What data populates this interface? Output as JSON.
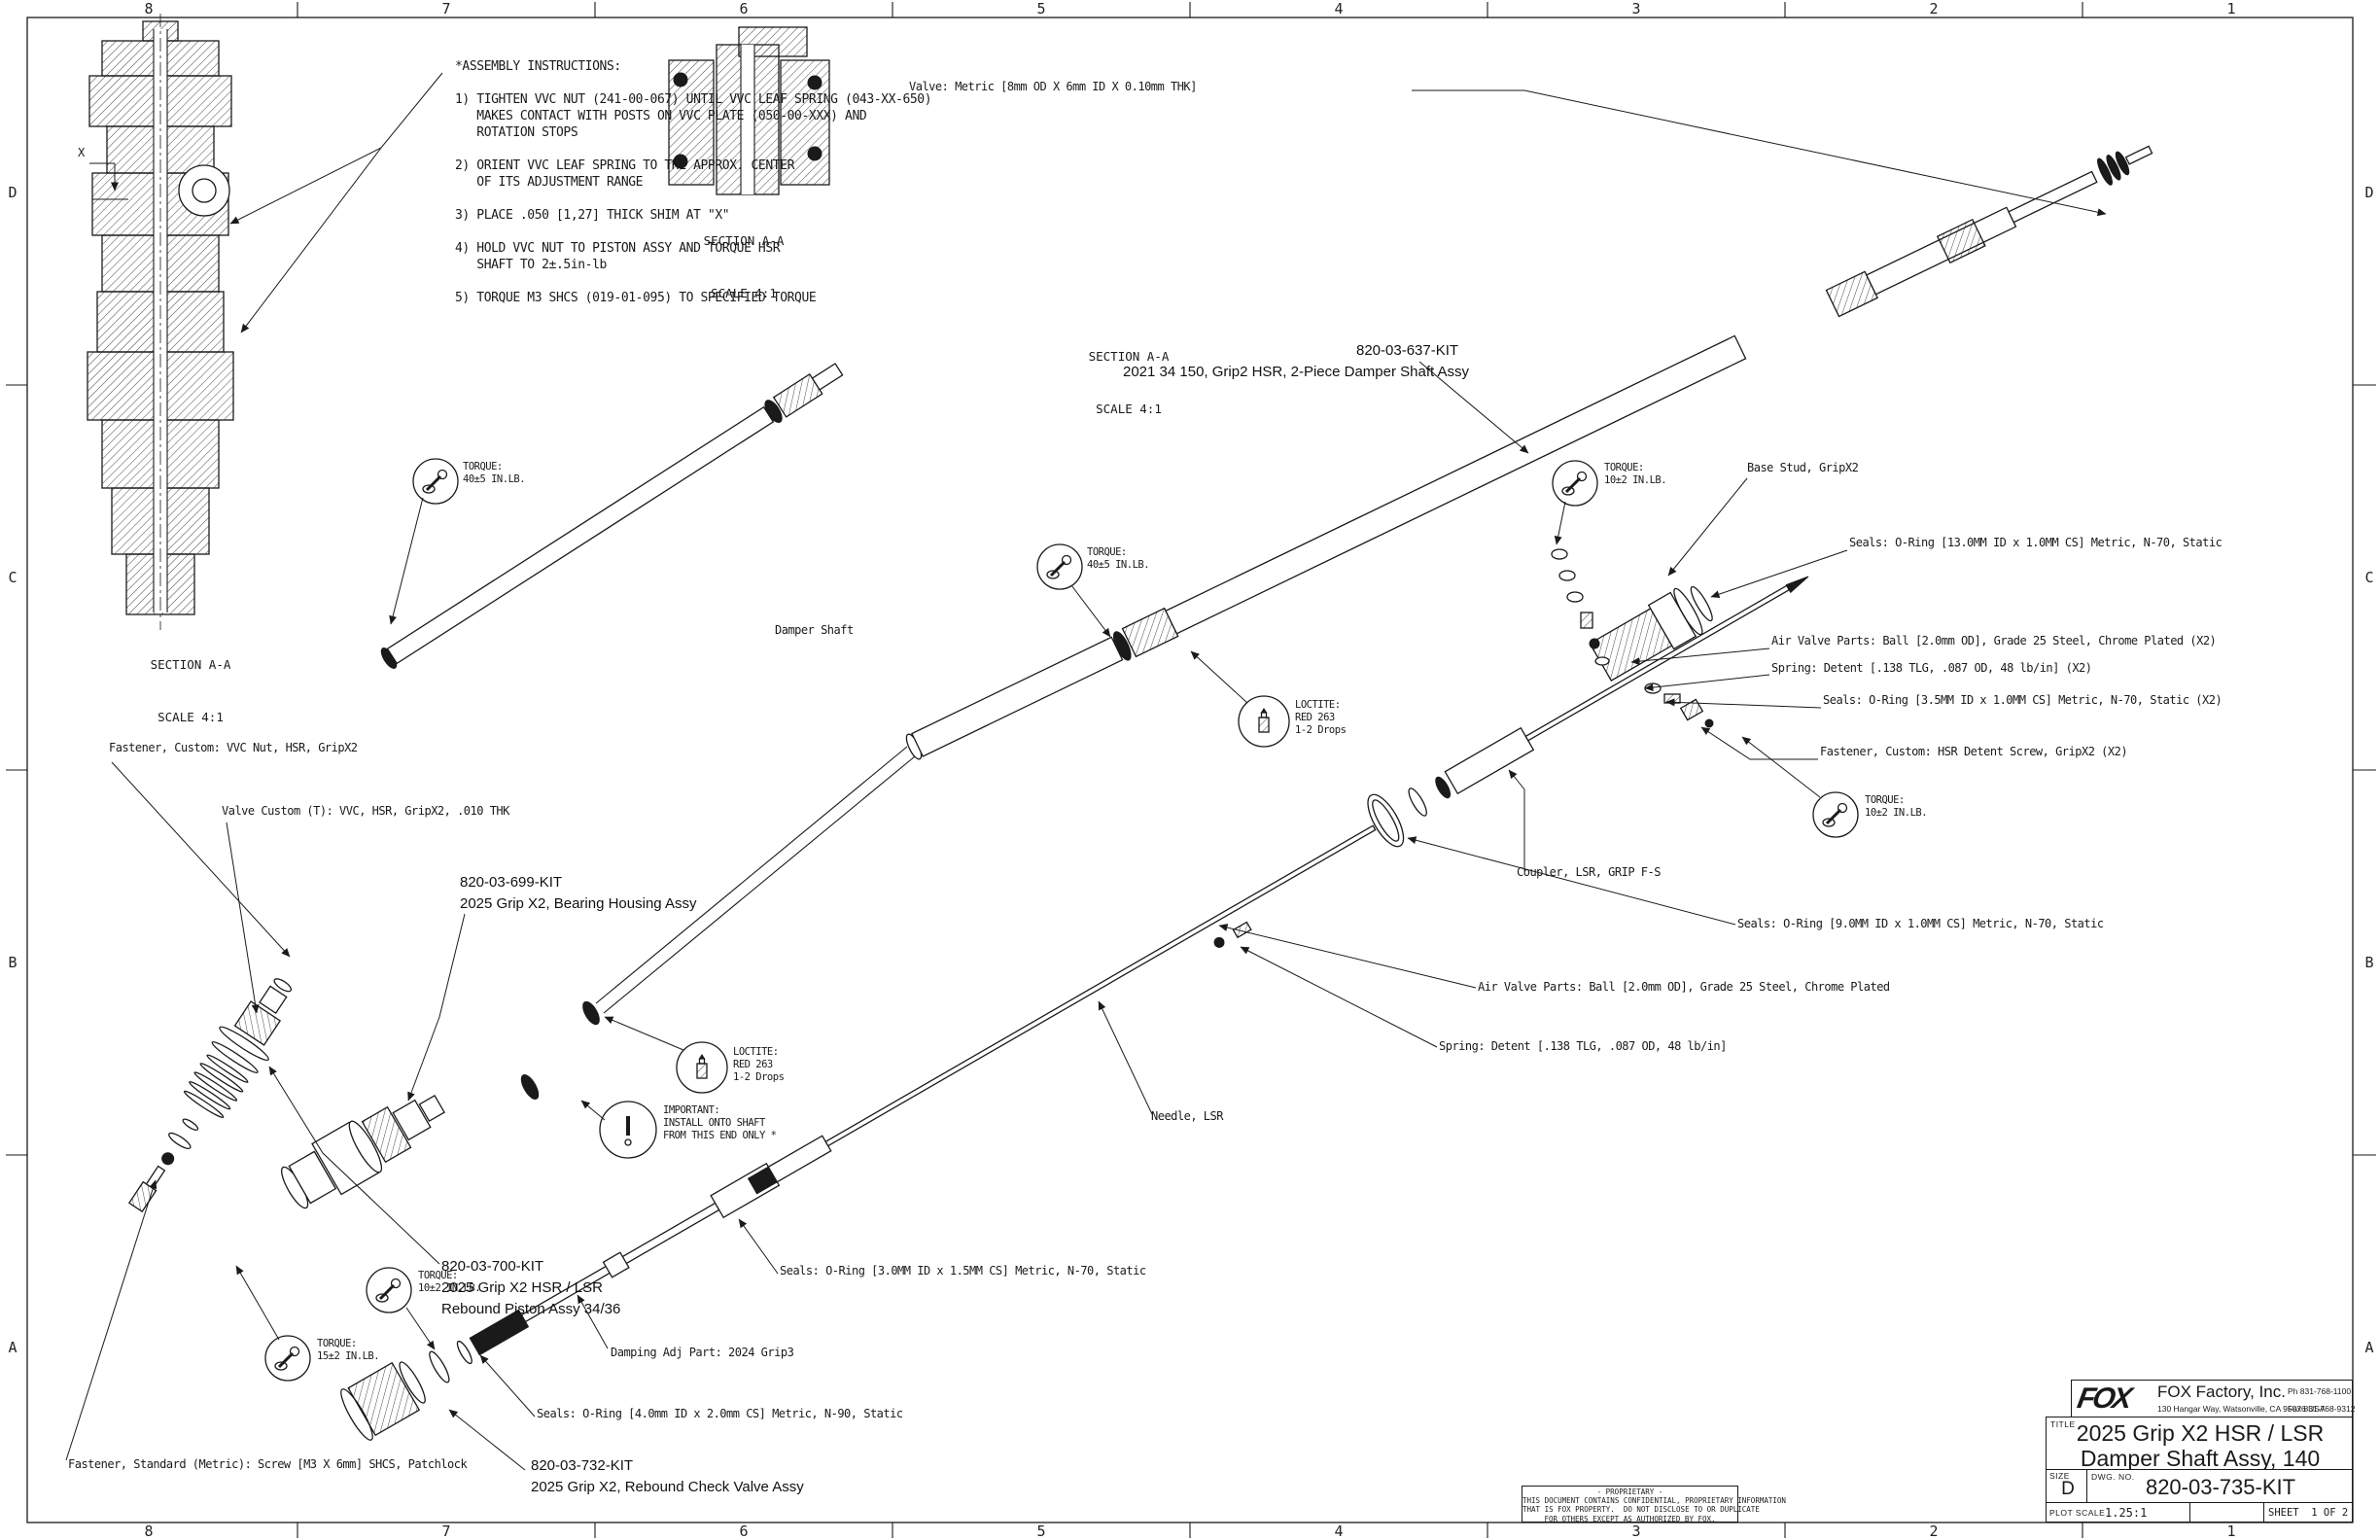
{
  "sheet": {
    "cols": [
      "8",
      "7",
      "6",
      "5",
      "4",
      "3",
      "2",
      "1"
    ],
    "rows": [
      "D",
      "C",
      "B",
      "A"
    ]
  },
  "instructions": {
    "lines": [
      "*ASSEMBLY INSTRUCTIONS:",
      "",
      "1) TIGHTEN VVC NUT (241-00-067) UNTIL VVC LEAF SPRING (043-XX-650)",
      "   MAKES CONTACT WITH POSTS ON VVC PLATE (050-00-XXX) AND",
      "   ROTATION STOPS",
      "",
      "2) ORIENT VVC LEAF SPRING TO THE APPROX. CENTER",
      "   OF ITS ADJUSTMENT RANGE",
      "",
      "3) PLACE .050 [1,27] THICK SHIM AT \"X\"",
      "",
      "4) HOLD VVC NUT TO PISTON ASSY AND TORQUE HSR",
      "   SHAFT TO 2±.5in-lb",
      "",
      "5) TORQUE M3 SHCS (019-01-095) TO SPECIFIED TORQUE"
    ]
  },
  "captions": {
    "section": "SECTION A-A",
    "scale": "SCALE 4:1"
  },
  "labels": {
    "x_dim": "X",
    "valve_metric": "Valve: Metric [8mm OD X 6mm ID X 0.10mm THK]",
    "damper_shaft": "Damper Shaft",
    "base_stud": "Base Stud, GripX2",
    "seals_13": "Seals: O-Ring [13.0MM ID x 1.0MM CS] Metric, N-70, Static",
    "air_valve_x2": "Air Valve Parts: Ball [2.0mm OD], Grade 25 Steel, Chrome Plated (X2)",
    "spring_x2": "Spring: Detent [.138 TLG, .087 OD, 48 lb/in] (X2)",
    "seals_35": "Seals: O-Ring [3.5MM ID x 1.0MM CS] Metric, N-70, Static (X2)",
    "fastener_detent": "Fastener, Custom: HSR Detent Screw, GripX2 (X2)",
    "coupler": "Coupler, LSR, GRIP F-S",
    "seals_9": "Seals: O-Ring [9.0MM ID x 1.0MM CS] Metric, N-70, Static",
    "air_valve": "Air Valve Parts: Ball [2.0mm OD], Grade 25 Steel, Chrome Plated",
    "spring": "Spring: Detent [.138 TLG, .087 OD, 48 lb/in]",
    "needle": "Needle, LSR",
    "vvc_nut": "Fastener, Custom: VVC Nut, HSR, GripX2",
    "valve_custom": "Valve Custom (T): VVC, HSR, GripX2, .010 THK",
    "seals_30": "Seals: O-Ring [3.0MM ID x 1.5MM CS] Metric, N-70, Static",
    "damping_adj": "Damping Adj Part: 2024 Grip3",
    "seals_40": "Seals: O-Ring [4.0mm ID x 2.0mm CS] Metric, N-90, Static",
    "fastener_m3": "Fastener, Standard (Metric): Screw [M3 X 6mm] SHCS, Patchlock"
  },
  "kits": {
    "k637": {
      "lines": [
        "820-03-637-KIT"
      ]
    },
    "k637_desc": {
      "lines": [
        "2021 34 150, Grip2 HSR, 2-Piece Damper Shaft Assy"
      ]
    },
    "k699": {
      "lines": [
        "820-03-699-KIT",
        "2025 Grip X2, Bearing Housing Assy"
      ]
    },
    "k700": {
      "lines": [
        "820-03-700-KIT",
        "2025 Grip X2 HSR / LSR",
        "Rebound Piston Assy 34/36"
      ]
    },
    "k732": {
      "lines": [
        "820-03-732-KIT",
        "2025 Grip X2, Rebound Check Valve Assy"
      ]
    }
  },
  "badges": {
    "torque40": {
      "lines": [
        "TORQUE:",
        "40±5 IN.LB."
      ]
    },
    "torque10": {
      "lines": [
        "TORQUE:",
        "10±2 IN.LB."
      ]
    },
    "torque15": {
      "lines": [
        "TORQUE:",
        "15±2 IN.LB."
      ]
    },
    "loctite": {
      "lines": [
        "LOCTITE:",
        "RED 263",
        "1-2 Drops"
      ]
    },
    "important": {
      "lines": [
        "IMPORTANT:",
        "INSTALL ONTO SHAFT",
        "FROM THIS END ONLY *"
      ]
    }
  },
  "title_block": {
    "logo": "FOX",
    "company": "FOX Factory, Inc.",
    "address": "130 Hangar Way, Watsonville, CA 95076 USA",
    "phone": "Ph 831-768-1100",
    "fax": "Fax 831-768-9312",
    "title_label": "TITLE",
    "title_line1": "2025 Grip X2 HSR / LSR",
    "title_line2": "Damper Shaft Assy, 140",
    "size_label": "SIZE",
    "size": "D",
    "dwg_label": "DWG. NO.",
    "dwg_no": "820-03-735-KIT",
    "plot_label": "PLOT SCALE",
    "plot_scale": "1.25:1",
    "sheet_info": "SHEET  1 OF 2"
  },
  "proprietary": {
    "lines": [
      "- PROPRIETARY -",
      "THIS DOCUMENT CONTAINS CONFIDENTIAL, PROPRIETARY INFORMATION",
      "THAT IS FOX PROPERTY.  DO NOT DISCLOSE TO OR DUPLICATE",
      "FOR OTHERS EXCEPT AS AUTHORIZED BY FOX."
    ]
  }
}
